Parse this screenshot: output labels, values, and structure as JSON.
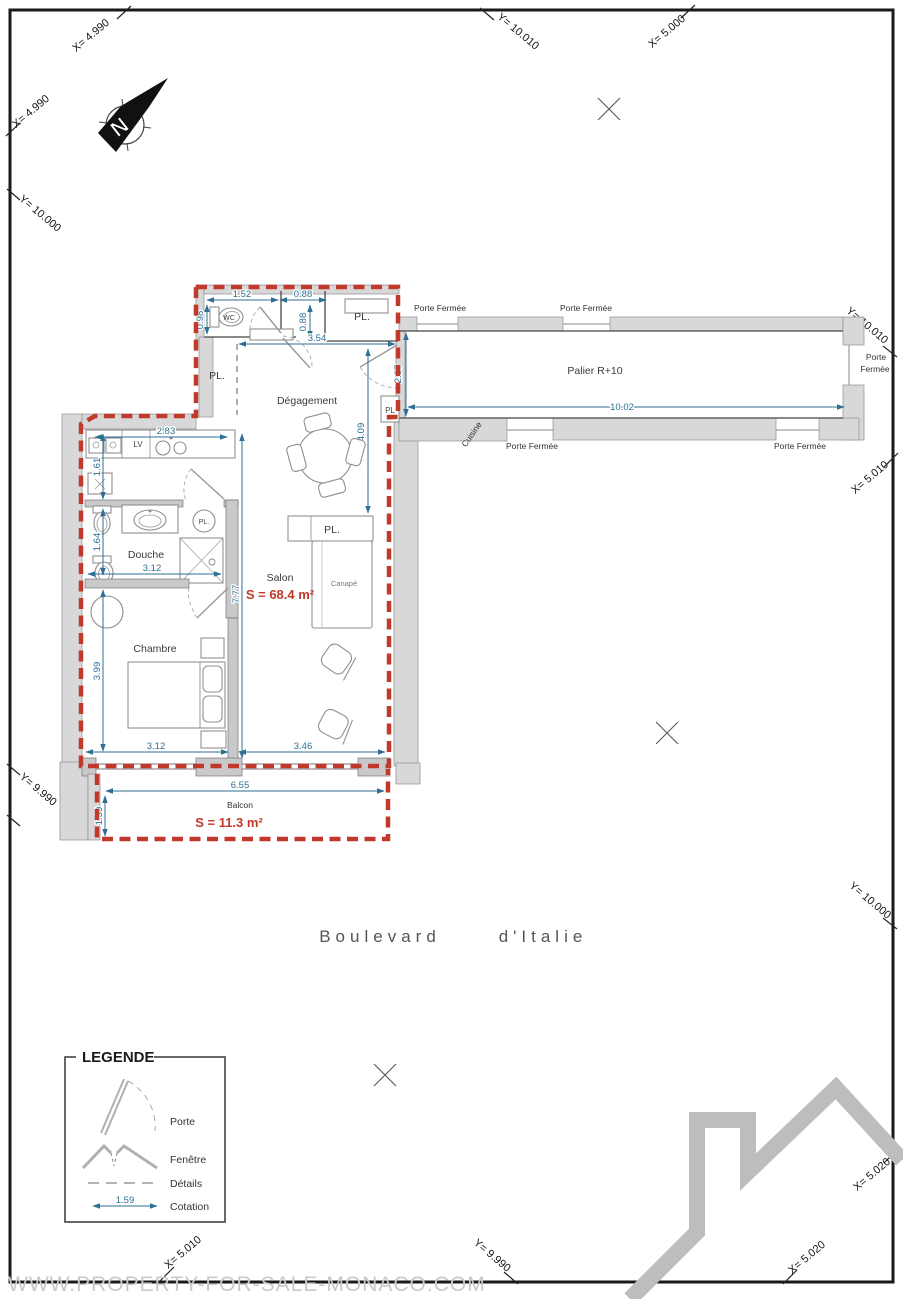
{
  "colors": {
    "outline_red": "#c0392b",
    "dimension_blue": "#2e6f93",
    "wall_gray": "#d8d8d8"
  },
  "compass": {
    "north": "N"
  },
  "grid": {
    "t1": "X= 4.990",
    "t2": "Y= 10.010",
    "t3": "X= 5.000",
    "l1": "X= 4.990",
    "l2": "Y= 10.000",
    "l3": "Y= 9.990",
    "r1": "Y= 10.010",
    "r2": "X= 5.010",
    "r3": "Y= 10.000",
    "r4": "X= 5.020",
    "b1": "X= 5.010",
    "b2": "Y= 9.990",
    "b3": "X= 5.020"
  },
  "corridor": {
    "name": "Palier R+10",
    "kitchen_label": "Cuisine",
    "closed_door": "Porte Fermée",
    "closed_door_line1": "Porte",
    "closed_door_line2": "Fermée",
    "length": "10.02",
    "depth": "2.07"
  },
  "apartment": {
    "entry": {
      "hall": "Dégagement",
      "wc": "WC",
      "closet": "PL.",
      "closet_left": "PL.",
      "closet_small": "PL",
      "dims": {
        "wc_width": "1.52",
        "niche_width": "0.88",
        "wc_depth": "0.98",
        "entry_depth": "0.88",
        "hall_width": "3.54",
        "hall_length": "4.09"
      }
    },
    "kitchen": {
      "dishwasher": "LV",
      "dims": {
        "width": "2.83",
        "depth": "1.61"
      }
    },
    "bathroom": {
      "name": "Douche",
      "closet": "PL.",
      "dims": {
        "width": "3.12",
        "depth": "1.64"
      }
    },
    "living": {
      "name": "Salon",
      "area": "S = 68.4 m²",
      "sofa": "Canapé",
      "wardrobe": "PL.",
      "dims": {
        "height": "7.77",
        "width": "3.46"
      }
    },
    "bedroom": {
      "name": "Chambre",
      "dims": {
        "height": "3.99",
        "width": "3.12"
      }
    },
    "balcony": {
      "name": "Balcon",
      "area": "S = 11.3 m²",
      "dims": {
        "width": "6.55",
        "depth": "1.39"
      }
    }
  },
  "street": {
    "part1": "Boulevard",
    "part2": "d'Italie"
  },
  "legend": {
    "title": "LEGENDE",
    "porte": "Porte",
    "fenetre": "Fenêtre",
    "details": "Détails",
    "cotation": "Cotation",
    "sample_value": "1.59"
  },
  "watermark": "WWW.PROPERTY-FOR-SALE-MONACO.COM"
}
